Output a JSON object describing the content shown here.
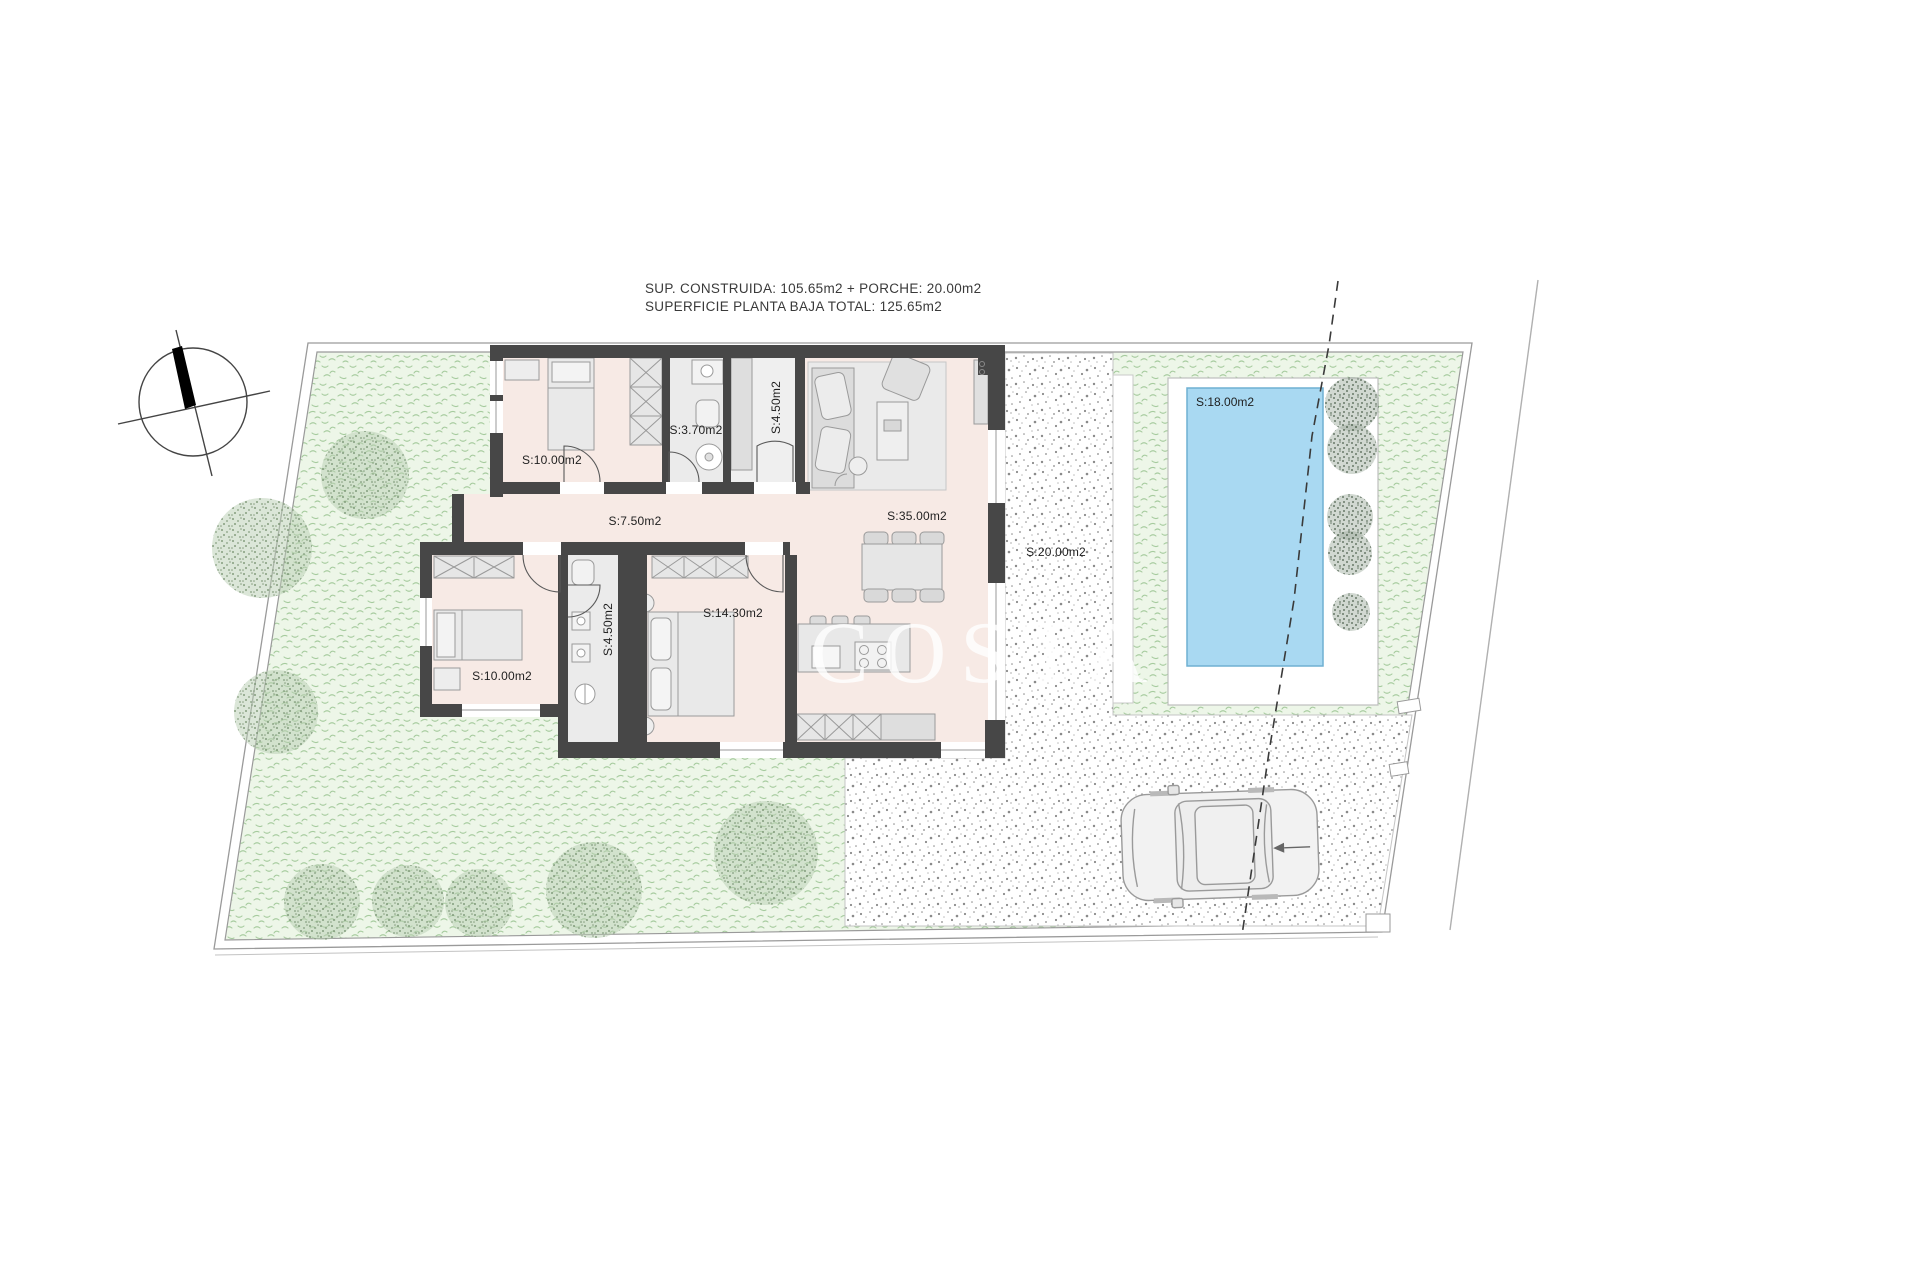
{
  "title": {
    "line1": "SUP. CONSTRUIDA: 105.65m2 + PORCHE: 20.00m2",
    "line2": "SUPERFICIE PLANTA BAJA TOTAL: 125.65m2"
  },
  "rooms": {
    "bedroom_top": "S:10.00m2",
    "bathroom_top": "S:3.70m2",
    "laundry": "S:4.50m2",
    "hallway": "S:7.50m2",
    "living": "S:35.00m2",
    "porch": "S:20.00m2",
    "bedroom_left": "S:10.00m2",
    "bathroom_left": "S:4.50m2",
    "master_bedroom": "S:14.30m2",
    "pool": "S:18.00m2"
  },
  "watermark": "COSTA",
  "watermark_tail": "S",
  "colors": {
    "wall": "#474747",
    "floor": "#f7eae5",
    "bath_floor": "#ebebeb",
    "pool_water": "#a9d9f2",
    "pool_edge": "#6fb0d2",
    "garden": "#edf6e8",
    "garden_mark": "#a6cb9e",
    "stipple_dot": "#8a8a8a",
    "boundary": "#9a9a9a",
    "furniture": "#e3e3e3"
  }
}
